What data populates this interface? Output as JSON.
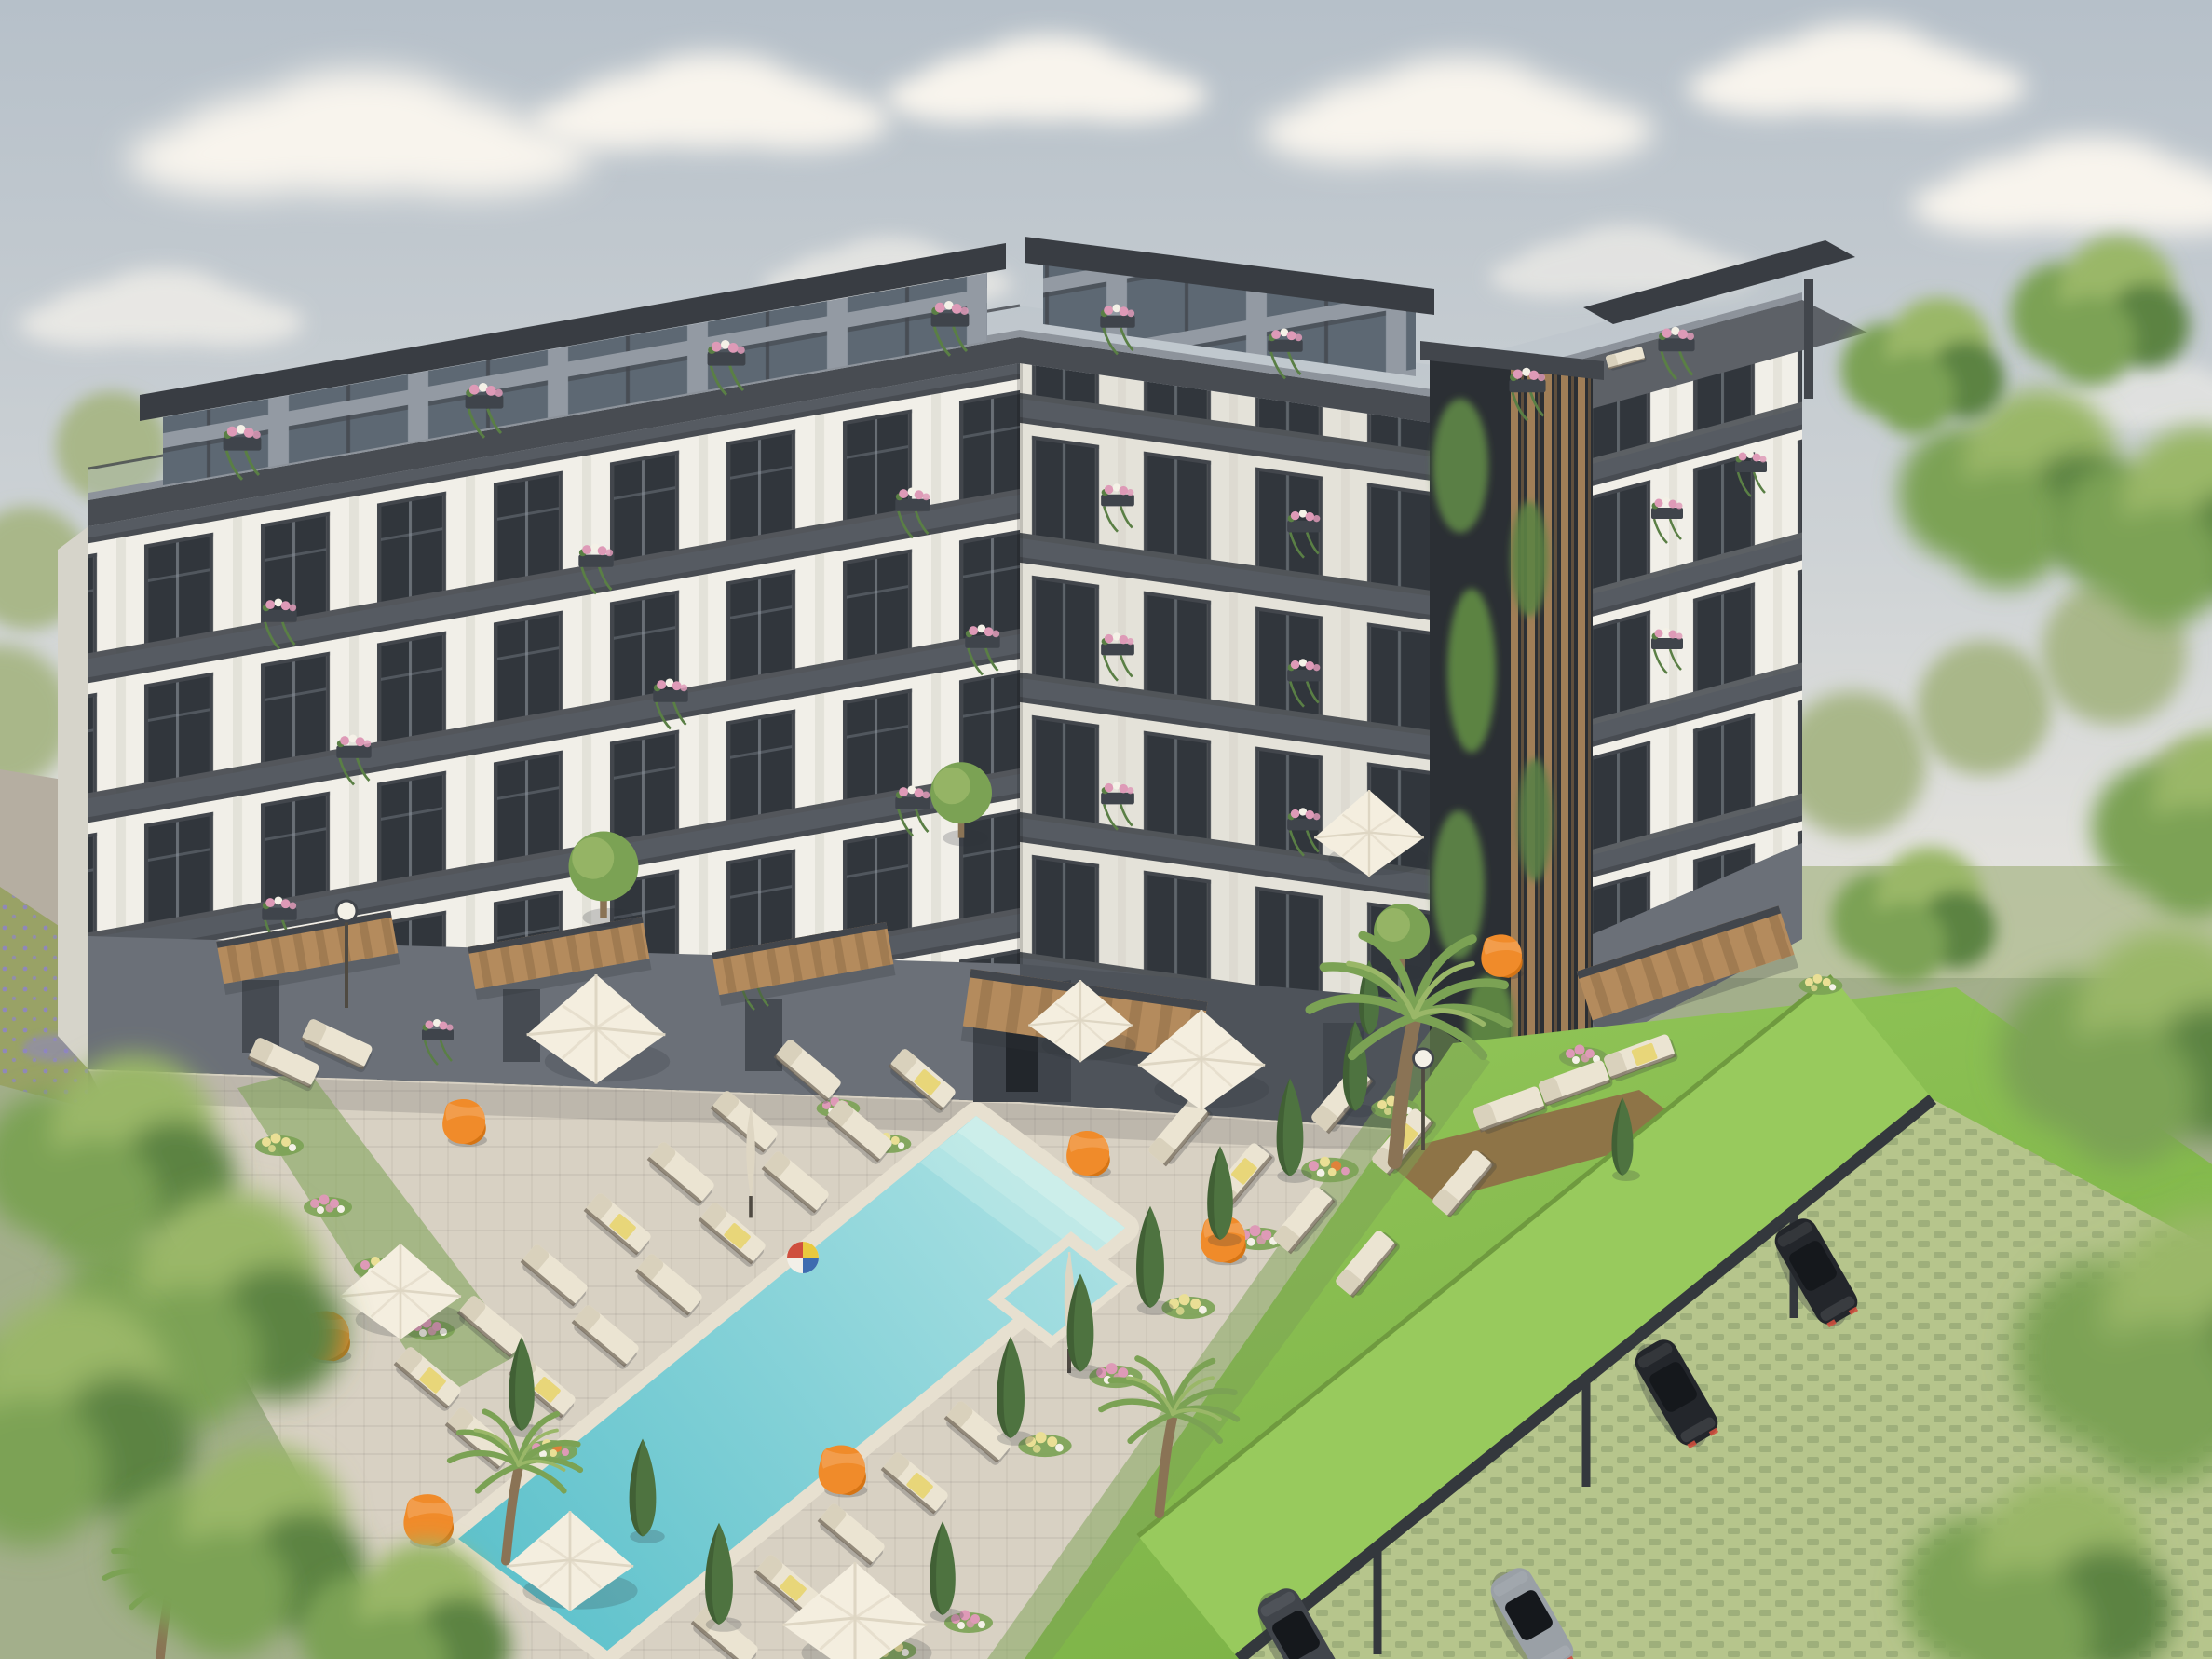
{
  "scene": {
    "description": "Aerial 3D architectural rendering of a modern six-storey U-shaped apartment complex: white facades with dark grey trim and floor-to-ceiling windows, glass balconies with pink trailing flower boxes, a setback penthouse level with rooftop terraces, a dark living-green wall with wooden slats on the right wing, and a landscaped courtyard featuring a turquoise swimming pool with steps and jacuzzi, a beach ball, cream sun loungers, white parasols, orange bean bags, cypress and palm trees, flower beds, bright lawns, a green-roofed carport with parked cars, all surrounded by leafy trees under a hazy pale-blue summer sky with soft clouds.",
    "type": "3d-architectural-rendering",
    "view": "aerial-courtyard"
  },
  "inventory": {
    "building_floors": 6,
    "swimming_pools": 1,
    "jacuzzis": 1,
    "beach_balls": 1,
    "parasols_open": 7,
    "parasols_closed": 2,
    "sun_loungers": 32,
    "bean_bags": 7,
    "cypress_trees": 12,
    "palm_trees": 4,
    "round_trees": 3,
    "balcony_flower_boxes": 27,
    "pergola_awnings": 5,
    "carports": 1,
    "cars": 4,
    "lamp_posts": 2,
    "clouds": 10
  },
  "colors": {
    "sky_top": "#b6c0c9",
    "sky_mid": "#cdd2d5",
    "sky_horizon": "#eae7e0",
    "cloud": "#f8f4ed",
    "foliage_back": "#a9b789",
    "foliage_light": "#9ab768",
    "foliage_mid": "#7ba254",
    "foliage_dark": "#5c8343",
    "cypress": "#4e7340",
    "trunk": "#8a7355",
    "facade_white": "#f1efe8",
    "facade_shadow": "#e4e2d9",
    "side_shadow": "#d6d4ca",
    "pier_shade": "#dbd8ce",
    "glass": "#31363c",
    "glass_light": "#5d6873",
    "mullion": "#8d959c",
    "trim_dark": "#42464c",
    "parapet": "#484c52",
    "coping_light": "#8d939b",
    "roof_slab": "#393d43",
    "pent_grey": "#939aa3",
    "rail": "#565b62",
    "ground_grey": "#6b7078",
    "ground_dark": "#4e535a",
    "recess_dark": "#3f444b",
    "greenwall_bg": "#2b2f34",
    "vine": "#5a7f45",
    "wood": "#b48b5d",
    "wood_dark": "#8e6c46",
    "paving": "#d8d1c3",
    "path_grey": "#b5aea1",
    "lawn": "#90c457",
    "lawn_deep": "#7cb246",
    "meadow": "#99a266",
    "lavender": "#8e84c8",
    "pool_shallow": "#abe1e3",
    "pool_deep": "#5fc2cc",
    "pool_step": "#cdeeea",
    "coping": "#e7e0d0",
    "lounger": "#ebe4d2",
    "lounger_back": "#d9d1bc",
    "frame_dark": "#6e6455",
    "towel": "#e8d679",
    "umbrella": "#f4eedf",
    "umbrella_fold": "#ded6c3",
    "pole": "#4f4a42",
    "beanbag": "#f08b2a",
    "beanbag_shade": "#d57414",
    "flower_pink": "#de9ab7",
    "flower_yellow": "#eadf95",
    "flower_white": "#f4f1e7",
    "flower_orange": "#df823b",
    "carport_roof": "#98ca5d",
    "carport_edge": "#34383d",
    "paver_grass": "#b6c58c",
    "paver_dark": "#8a9c6d",
    "car_dark": "#23262b",
    "car_grey": "#41454b",
    "car_silver": "#9aa0a6",
    "car_glass": "#15181c",
    "ball_red": "#cf4f3e",
    "ball_yellow": "#e9c93f",
    "ball_blue": "#3e6cb0",
    "shadow": "#2f3439"
  }
}
